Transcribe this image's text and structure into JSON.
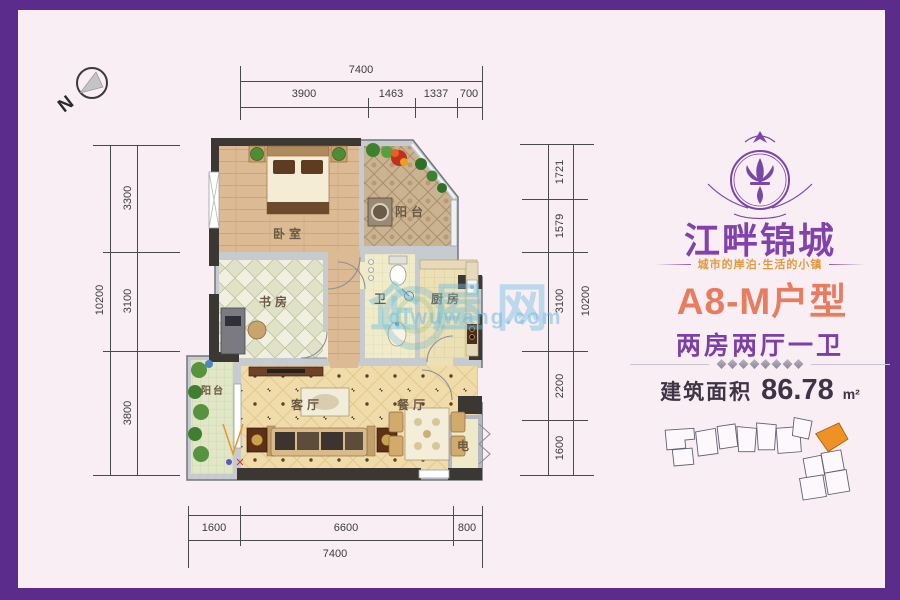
{
  "compass": {
    "label": "N"
  },
  "dims": {
    "top": {
      "total": "7400",
      "segments": [
        "3900",
        "1463",
        "1337",
        "700"
      ]
    },
    "bottom": {
      "total": "7400",
      "segments": [
        "1600",
        "6600",
        "800"
      ]
    },
    "left": {
      "total": "10200",
      "segments": [
        "3300",
        "3100",
        "3800"
      ]
    },
    "right": {
      "total": "10200",
      "segments": [
        "1721",
        "1579",
        "3100",
        "2200",
        "1600"
      ]
    }
  },
  "plan": {
    "rooms": {
      "bedroom": "卧室",
      "balcony_top": "阳台",
      "study": "书房",
      "bath": "卫",
      "kitchen": "厨房",
      "living": "客厅",
      "dining": "餐厅",
      "balcony_bottom": "阳台",
      "elevator": "电"
    }
  },
  "watermark": {
    "brand": "企屋网",
    "domain": "qiwuwang.com"
  },
  "panel": {
    "brand": "江畔锦城",
    "tagline": "城市的岸泊·生活的小镇",
    "unit_title": "A8-M户型",
    "layout": "两房两厅一卫",
    "area_label": "建筑面积",
    "area_value": "86.78",
    "area_unit": "m²"
  },
  "colors": {
    "frame_purple": "#5b2c8c",
    "background": "#f9eef3",
    "brand_purple": "#8242ac",
    "tagline_orange": "#e09a3e",
    "unit_coral": "#e87c5f",
    "layout_purple": "#7b3fa8",
    "area_dark": "#3f3346",
    "siteplan_highlight": "#ef9226"
  }
}
